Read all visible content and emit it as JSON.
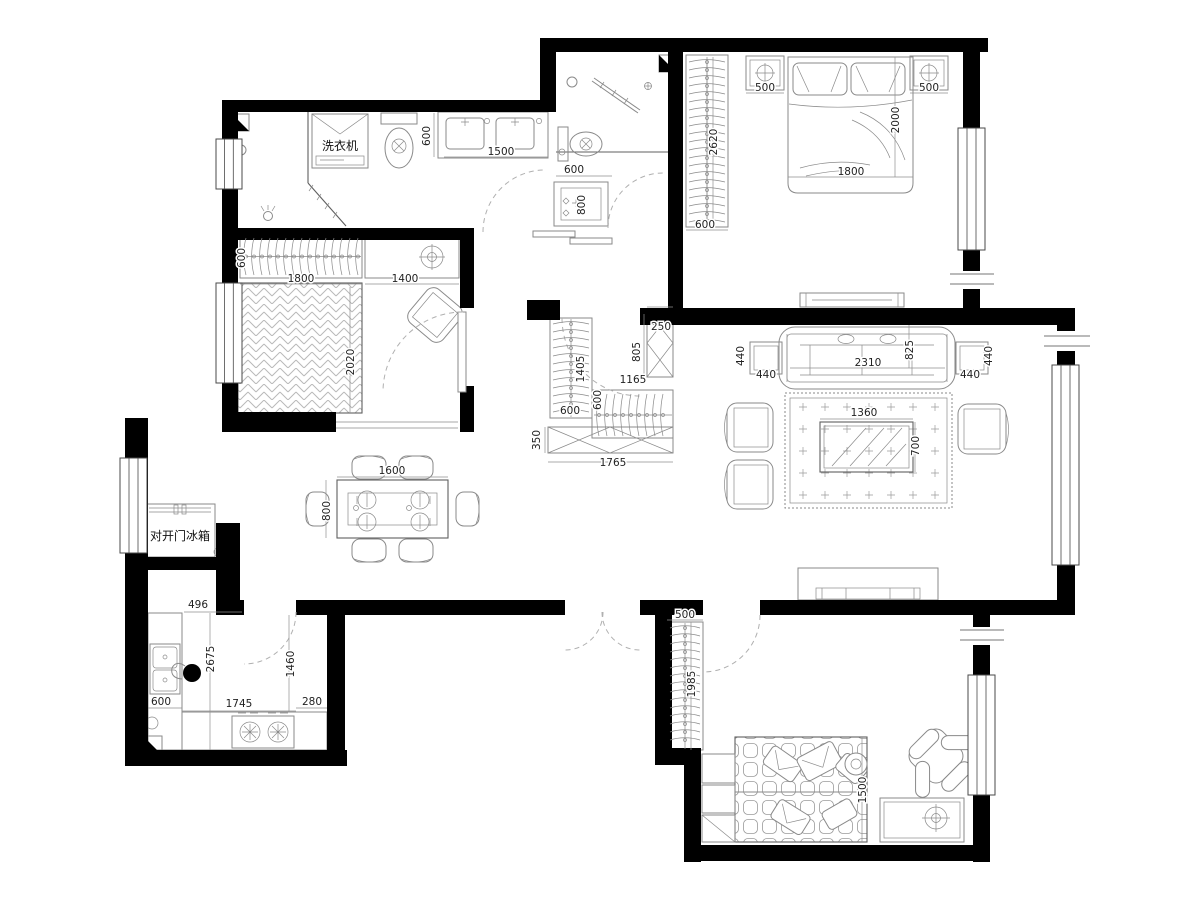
{
  "drawing": {
    "type": "floor-plan",
    "units": "mm",
    "colors": {
      "wall": "#000000",
      "furniture_line": "#8a8a8a",
      "dash": "#b0b0b0",
      "dimension_text": "#222222",
      "hatch": "#b9b9b9",
      "background": "#ffffff"
    },
    "room_labels": [
      {
        "id": "washing-machine-label",
        "text": "洗衣机",
        "x": 340,
        "y": 150
      },
      {
        "id": "fridge-label",
        "text": "对开门冰箱",
        "x": 180,
        "y": 540
      }
    ],
    "dimensions": [
      {
        "text": "600",
        "x": 430,
        "y": 136,
        "rot": -90
      },
      {
        "text": "1500",
        "x": 501,
        "y": 155,
        "rot": 0
      },
      {
        "text": "600",
        "x": 574,
        "y": 173,
        "rot": 0
      },
      {
        "text": "800",
        "x": 585,
        "y": 205,
        "rot": -90
      },
      {
        "text": "2620",
        "x": 717,
        "y": 142,
        "rot": -90
      },
      {
        "text": "600",
        "x": 705,
        "y": 228,
        "rot": 0
      },
      {
        "text": "500",
        "x": 765,
        "y": 91,
        "rot": 0
      },
      {
        "text": "500",
        "x": 929,
        "y": 91,
        "rot": 0
      },
      {
        "text": "2000",
        "x": 899,
        "y": 120,
        "rot": -90
      },
      {
        "text": "1800",
        "x": 851,
        "y": 175,
        "rot": 0
      },
      {
        "text": "600",
        "x": 245,
        "y": 258,
        "rot": -90
      },
      {
        "text": "1800",
        "x": 301,
        "y": 282,
        "rot": 0
      },
      {
        "text": "1400",
        "x": 405,
        "y": 282,
        "rot": 0
      },
      {
        "text": "2020",
        "x": 354,
        "y": 362,
        "rot": -90
      },
      {
        "text": "250",
        "x": 661,
        "y": 330,
        "rot": 0
      },
      {
        "text": "805",
        "x": 640,
        "y": 352,
        "rot": -90
      },
      {
        "text": "1405",
        "x": 584,
        "y": 369,
        "rot": -90
      },
      {
        "text": "1165",
        "x": 633,
        "y": 383,
        "rot": 0
      },
      {
        "text": "600",
        "x": 601,
        "y": 400,
        "rot": -90
      },
      {
        "text": "600",
        "x": 570,
        "y": 414,
        "rot": 0
      },
      {
        "text": "350",
        "x": 540,
        "y": 440,
        "rot": -90
      },
      {
        "text": "1765",
        "x": 613,
        "y": 466,
        "rot": 0
      },
      {
        "text": "440",
        "x": 744,
        "y": 356,
        "rot": -90
      },
      {
        "text": "440",
        "x": 766,
        "y": 378,
        "rot": 0
      },
      {
        "text": "2310",
        "x": 868,
        "y": 366,
        "rot": 0
      },
      {
        "text": "825",
        "x": 913,
        "y": 350,
        "rot": -90
      },
      {
        "text": "440",
        "x": 992,
        "y": 356,
        "rot": -90
      },
      {
        "text": "440",
        "x": 970,
        "y": 378,
        "rot": 0
      },
      {
        "text": "1360",
        "x": 864,
        "y": 416,
        "rot": 0
      },
      {
        "text": "700",
        "x": 919,
        "y": 446,
        "rot": -90
      },
      {
        "text": "1600",
        "x": 392,
        "y": 474,
        "rot": 0
      },
      {
        "text": "800",
        "x": 330,
        "y": 511,
        "rot": -90
      },
      {
        "text": "496",
        "x": 198,
        "y": 608,
        "rot": 0
      },
      {
        "text": "2675",
        "x": 214,
        "y": 659,
        "rot": -90
      },
      {
        "text": "1460",
        "x": 294,
        "y": 664,
        "rot": -90
      },
      {
        "text": "600",
        "x": 161,
        "y": 705,
        "rot": 0
      },
      {
        "text": "1745",
        "x": 239,
        "y": 707,
        "rot": 0
      },
      {
        "text": "280",
        "x": 312,
        "y": 705,
        "rot": 0
      },
      {
        "text": "500",
        "x": 685,
        "y": 618,
        "rot": 0
      },
      {
        "text": "1985",
        "x": 695,
        "y": 684,
        "rot": -90
      },
      {
        "text": "1500",
        "x": 866,
        "y": 790,
        "rot": -90
      }
    ]
  }
}
